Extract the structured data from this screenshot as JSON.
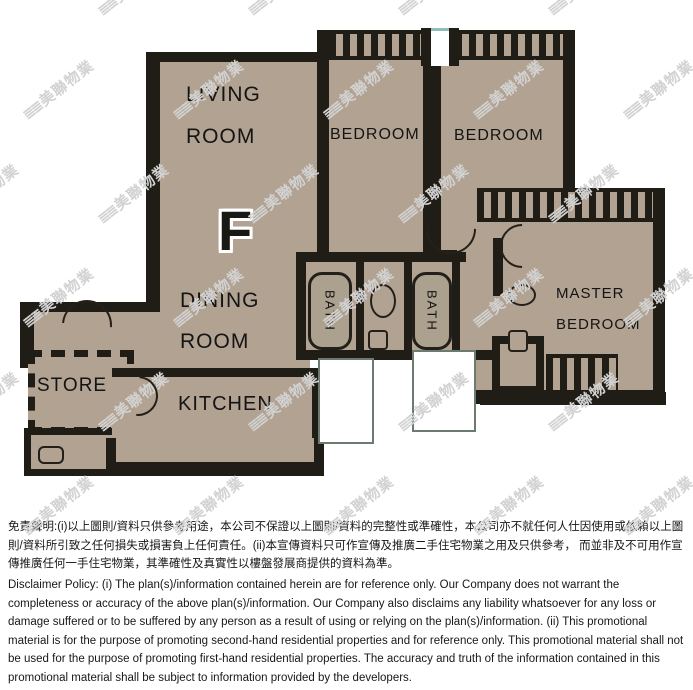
{
  "unit": {
    "letter": "F"
  },
  "rooms": {
    "living": {
      "line1": "LIVING",
      "line2": "ROOM"
    },
    "bedroom1": {
      "label": "BEDROOM"
    },
    "bedroom2": {
      "label": "BEDROOM"
    },
    "master": {
      "line1": "MASTER",
      "line2": "BEDROOM"
    },
    "dining": {
      "line1": "DINING",
      "line2": "ROOM"
    },
    "store": {
      "label": "STORE"
    },
    "kitchen": {
      "label": "KITCHEN"
    },
    "bath1": {
      "label": "BATH"
    },
    "bath2": {
      "label": "BATH"
    }
  },
  "watermark": {
    "logo": "≣≣",
    "text": "美聯物業"
  },
  "colors": {
    "wall": "#201d17",
    "floor": "#b1a292",
    "background": "#ffffff",
    "watermark": "#d2d2d2",
    "window_accent": "#8fbdb9"
  },
  "disclaimer": {
    "zh": "免責聲明:(i)以上圖則/資料只供參考用途，本公司不保證以上圖則/資料的完整性或準確性，本公司亦不就任何人仕因使用或依賴以上圖則/資料所引致之任何損失或損害負上任何責任。(ii)本宣傳資料只可作宣傳及推廣二手住宅物業之用及只供參考， 而並非及不可用作宣傳推廣任何一手住宅物業，其準確性及真實性以樓盤發展商提供的資料為準。",
    "en": "Disclaimer Policy: (i) The plan(s)/information contained herein are for reference only. Our Company does not warrant the completeness or accuracy of the above plan(s)/information. Our Company also disclaims any liability whatsoever for any loss or damage suffered or to be suffered by any person as a result of using or relying on the plan(s)/information. (ii) This promotional material is for the purpose of promoting second-hand residential properties and for reference only. This promotional material shall not be used for the purpose of promoting first-hand residential properties. The accuracy and truth of the information contained in this promotional material shall be subject to information provided by the developers."
  }
}
